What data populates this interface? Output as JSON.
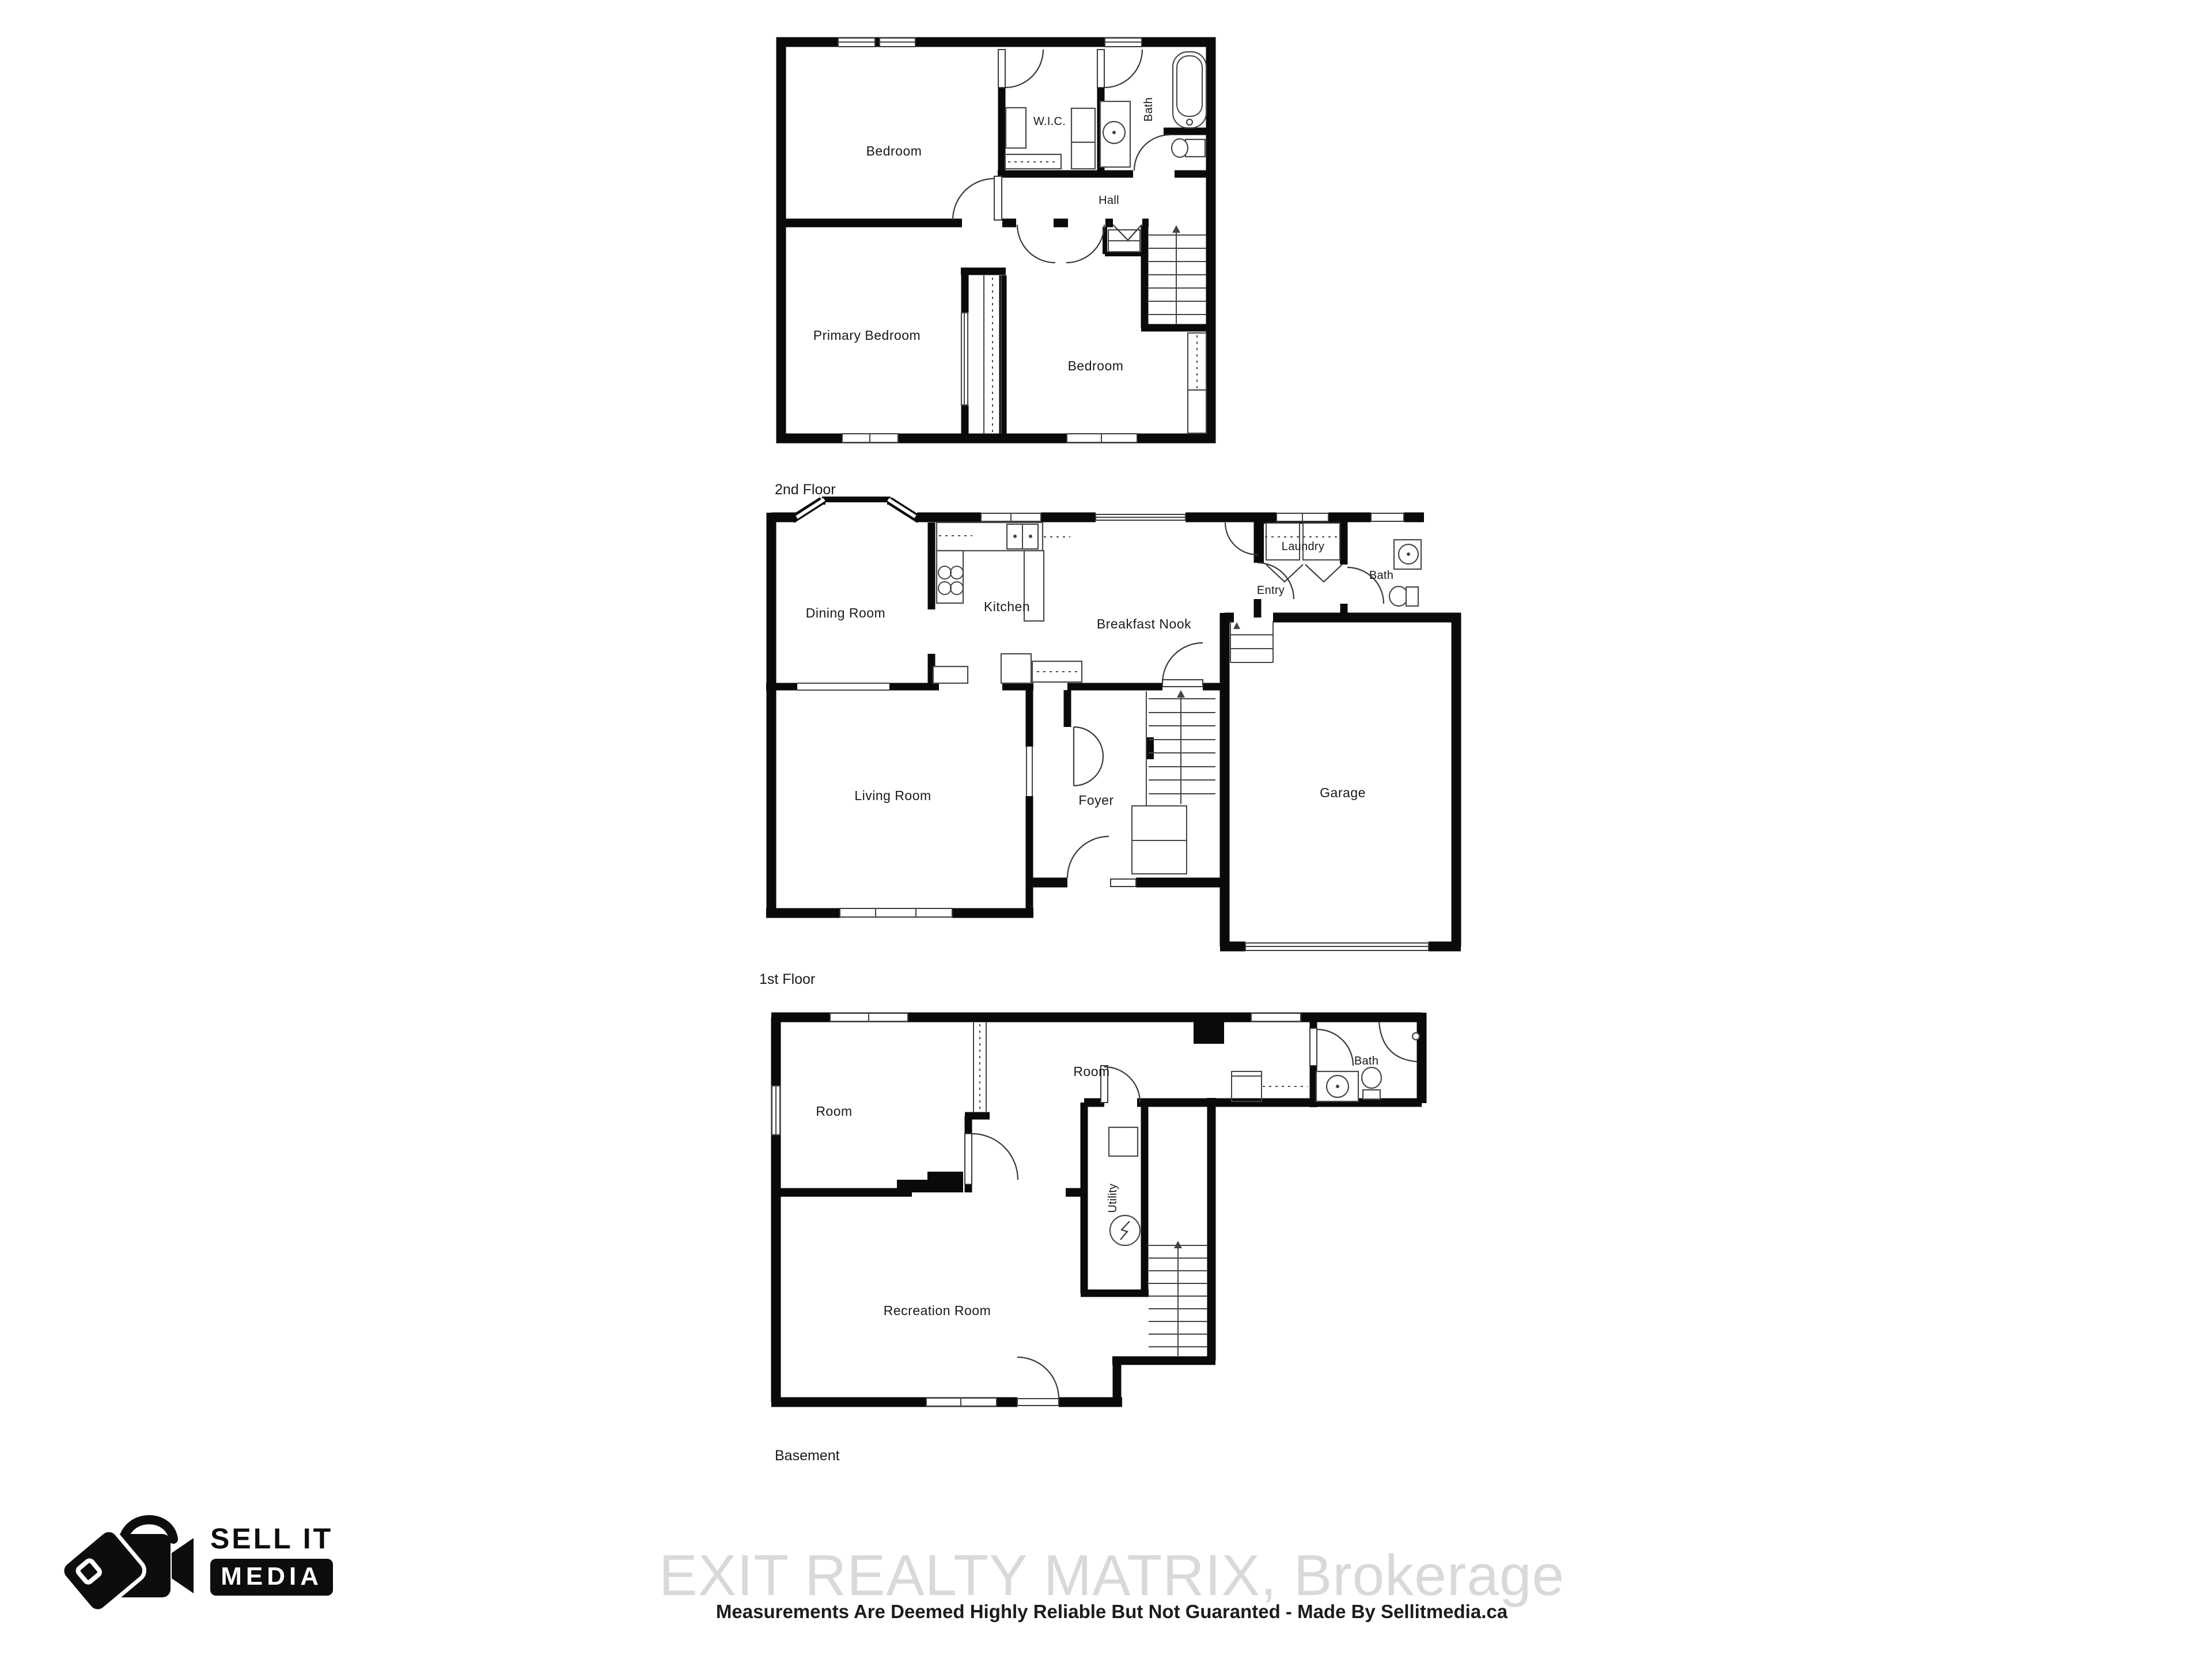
{
  "document": {
    "type": "real-estate-floor-plan",
    "background": "#ffffff"
  },
  "colors": {
    "wall": "#0a0a0a",
    "line": "#444444",
    "label": "#1a1a1a",
    "watermark": "#d9d9d9",
    "logo": "#0d0d0d",
    "background": "#ffffff"
  },
  "floors": [
    {
      "name": "2nd Floor",
      "rooms": [
        {
          "label": "Bedroom"
        },
        {
          "label": "W.I.C."
        },
        {
          "label": "Bath"
        },
        {
          "label": "Hall"
        },
        {
          "label": "Primary Bedroom"
        },
        {
          "label": "Bedroom"
        }
      ]
    },
    {
      "name": "1st Floor",
      "rooms": [
        {
          "label": "Dining Room"
        },
        {
          "label": "Kitchen"
        },
        {
          "label": "Breakfast Nook"
        },
        {
          "label": "Laundry"
        },
        {
          "label": "Entry"
        },
        {
          "label": "Bath"
        },
        {
          "label": "Living Room"
        },
        {
          "label": "Foyer"
        },
        {
          "label": "Garage"
        }
      ]
    },
    {
      "name": "Basement",
      "rooms": [
        {
          "label": "Room"
        },
        {
          "label": "Room"
        },
        {
          "label": "Bath"
        },
        {
          "label": "Utility"
        },
        {
          "label": "Recreation Room"
        }
      ]
    }
  ],
  "footer": {
    "logo": {
      "line1": "SELL IT",
      "line2": "MEDIA",
      "icon": "camera-tag-icon"
    },
    "watermark": "EXIT REALTY MATRIX, Brokerage",
    "disclaimer": "Measurements Are Deemed Highly Reliable But Not Guaranted - Made By Sellitmedia.ca"
  }
}
